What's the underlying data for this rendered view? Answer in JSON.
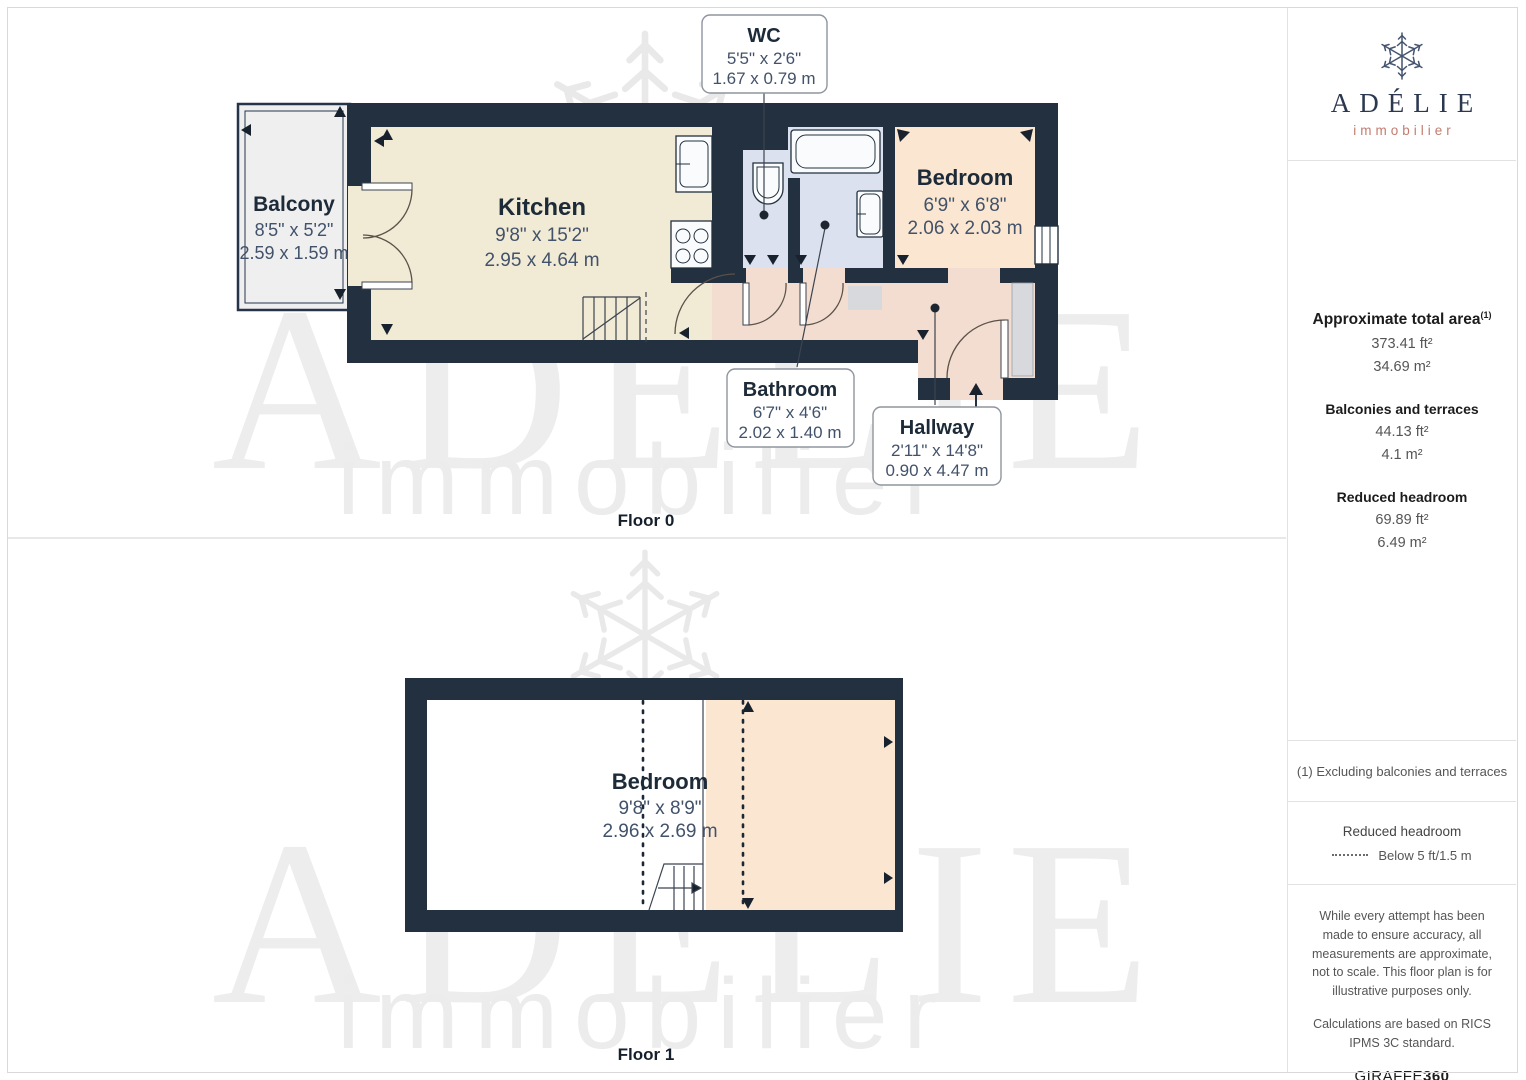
{
  "brand": {
    "name": "ADÉLIE",
    "tagline": "immobilier",
    "navy": "#2b3850",
    "salmon": "#c47b6e"
  },
  "watermark": {
    "line1": "ADÉLIE",
    "line2": "immobilier"
  },
  "colors": {
    "wall": "#22303f",
    "kitchen_floor": "#f1ead5",
    "bedroom_floor": "#fbe7d1",
    "hallway_floor": "#f3dcd0",
    "bathroom_floor": "#dbe1ee",
    "balcony_floor": "#efeff0"
  },
  "floors": [
    {
      "label": "Floor 0",
      "rooms": [
        {
          "name": "Balcony",
          "imperial": "8'5\" x 5'2\"",
          "metric": "2.59 x 1.59 m"
        },
        {
          "name": "Kitchen",
          "imperial": "9'8\" x 15'2\"",
          "metric": "2.95 x 4.64 m"
        },
        {
          "name": "WC",
          "imperial": "5'5\" x 2'6\"",
          "metric": "1.67 x 0.79 m"
        },
        {
          "name": "Bedroom",
          "imperial": "6'9\" x 6'8\"",
          "metric": "2.06 x 2.03 m"
        },
        {
          "name": "Bathroom",
          "imperial": "6'7\" x 4'6\"",
          "metric": "2.02 x 1.40 m"
        },
        {
          "name": "Hallway",
          "imperial": "2'11\" x 14'8\"",
          "metric": "0.90 x 4.47 m"
        }
      ]
    },
    {
      "label": "Floor 1",
      "rooms": [
        {
          "name": "Bedroom",
          "imperial": "9'8\" x 8'9\"",
          "metric": "2.96 x 2.69 m"
        }
      ]
    }
  ],
  "sidebar": {
    "total_area": {
      "title": "Approximate total area",
      "marker": "(1)",
      "ft": "373.41 ft²",
      "m": "34.69 m²"
    },
    "balconies": {
      "title": "Balconies and terraces",
      "ft": "44.13 ft²",
      "m": "4.1 m²"
    },
    "reduced_headroom": {
      "title": "Reduced headroom",
      "ft": "69.89 ft²",
      "m": "6.49 m²"
    },
    "footnote": "(1) Excluding balconies and terraces",
    "legend": {
      "title": "Reduced headroom",
      "item": "Below 5 ft/1.5 m"
    },
    "disclaimer1": "While every attempt has been made to ensure accuracy, all measurements are approximate, not to scale. This floor plan is for illustrative purposes only.",
    "disclaimer2": "Calculations are based on RICS IPMS 3C standard.",
    "brand_footer": {
      "giraffe": "GIRAFFE",
      "threesixty": "360"
    }
  }
}
